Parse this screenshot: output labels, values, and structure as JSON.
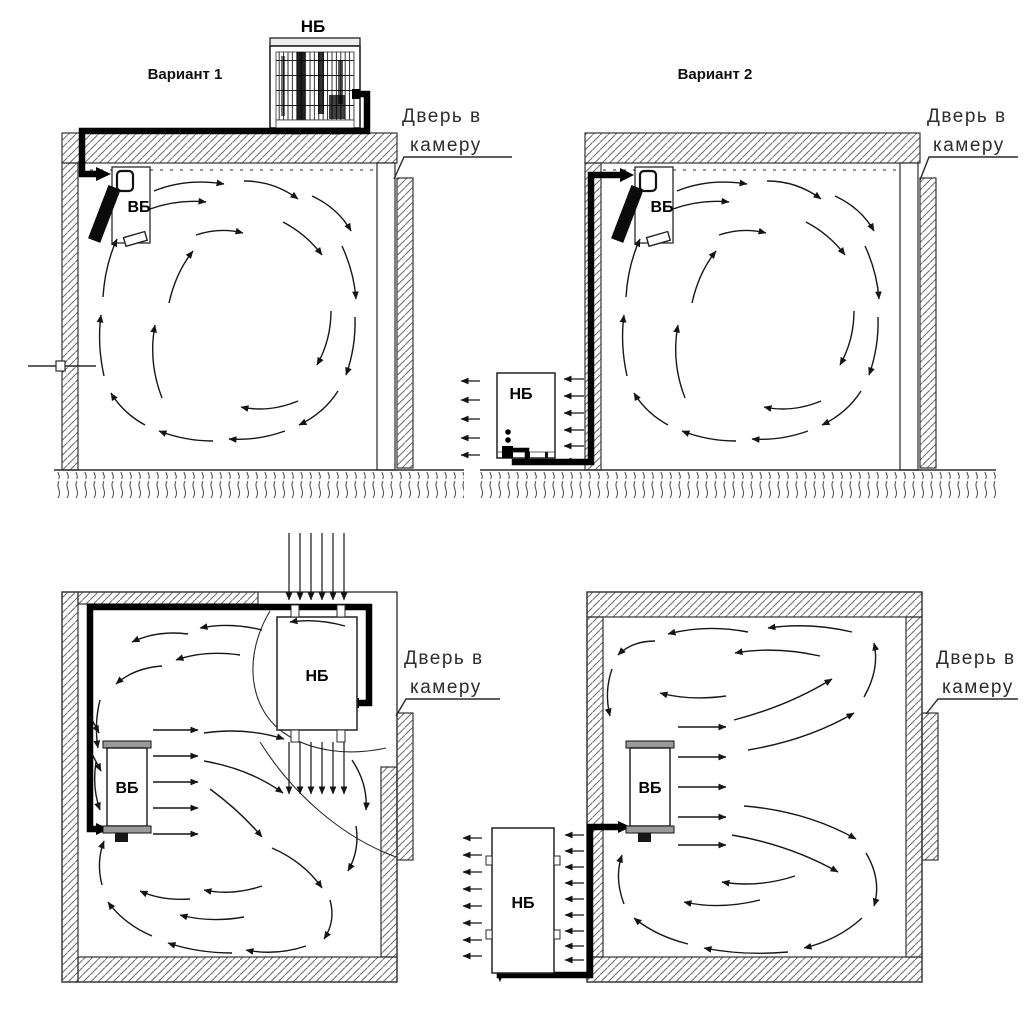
{
  "drawing": {
    "variant1_title": "Вариант 1",
    "variant2_title": "Вариант 2",
    "door_label": {
      "line1": "Дверь в",
      "line2": "камеру"
    },
    "outdoor_unit_label": "НБ",
    "indoor_unit_label": "ВБ",
    "colors": {
      "ink": "#1a1a1a",
      "pipe": "#000000",
      "hatch": "#666666",
      "paper": "#ffffff"
    }
  }
}
